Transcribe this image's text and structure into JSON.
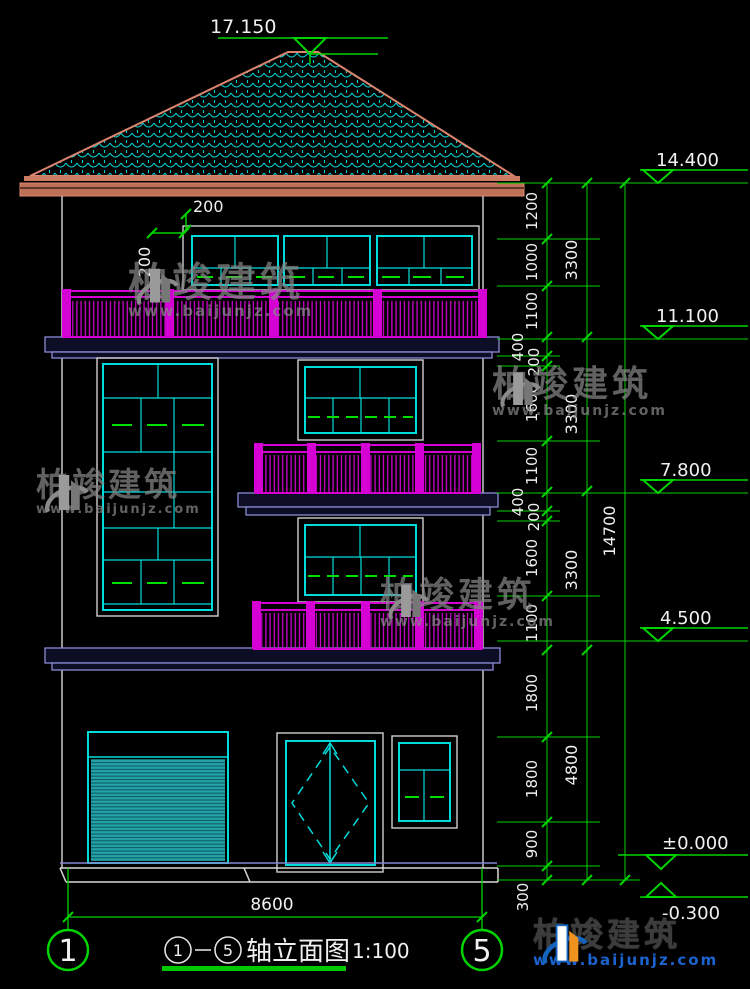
{
  "levels": {
    "top": "17.150",
    "right": [
      "14.400",
      "11.100",
      "7.800",
      "4.500",
      "±0.000",
      "-0.300"
    ]
  },
  "dims": {
    "chain_inner": [
      "1200",
      "1000",
      "1100",
      "400",
      "200",
      "1600",
      "1100",
      "400",
      "200",
      "1600",
      "1100",
      "1800",
      "1800",
      "900",
      "300"
    ],
    "chain_storey": [
      "3300",
      "3300",
      "3300",
      "4800"
    ],
    "total_height": "14700",
    "total_width": "8600",
    "detail": [
      "200",
      "200"
    ]
  },
  "axes": {
    "left": "1",
    "right": "5"
  },
  "title": {
    "axis_start": "1",
    "axis_end": "5",
    "name": "轴立面图",
    "scale": "1:100"
  },
  "watermark": {
    "cn": "柏竣建筑",
    "url": "www.baijunjz.com"
  },
  "colors": {
    "dimension_green": "#00d400",
    "opening_dash_green": "#00e000",
    "window_cyan": "#00dcdc",
    "railing_magenta": "#d400d4",
    "roof_edge_salmon": "#d4785f",
    "slab_outline_blue": "#8a8ad6",
    "text_white": "#f0f0f0",
    "watermark_gray": "#878787",
    "logo_blue": "#1565c0",
    "logo_orange": "#f0921e"
  }
}
